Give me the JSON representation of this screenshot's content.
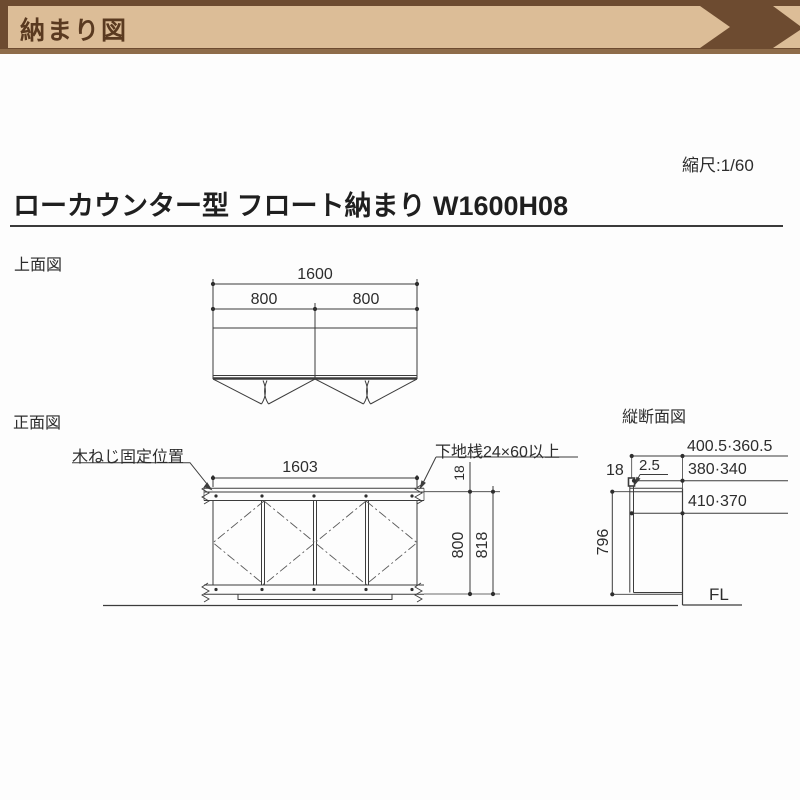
{
  "banner": {
    "label": "納まり図"
  },
  "scale": {
    "label": "縮尺:1/60"
  },
  "page_title": "ローカウンター型 フロート納まり W1600H08",
  "top_view": {
    "label": "上面図",
    "dim_overall": "1600",
    "dim_left": "800",
    "dim_right": "800"
  },
  "front_view": {
    "label": "正面図",
    "dim_width": "1603",
    "dim_top_thickness": "18",
    "dim_body_height": "800",
    "dim_total_height": "818",
    "note_screw": "木ねじ固定位置",
    "note_rail": "下地桟24×60以上"
  },
  "section_view": {
    "label": "縦断面図",
    "dim_depth_overall": "400.5·360.5",
    "dim_depth_body": "380·340",
    "dim_depth_front": "410·370",
    "dim_top_thickness": "18",
    "dim_overhang": "2.5",
    "dim_height": "796",
    "floor_label": "FL"
  },
  "colors": {
    "banner_brown": "#6d4b30",
    "banner_tan": "#dcbd97",
    "line": "#3c3c3c"
  }
}
